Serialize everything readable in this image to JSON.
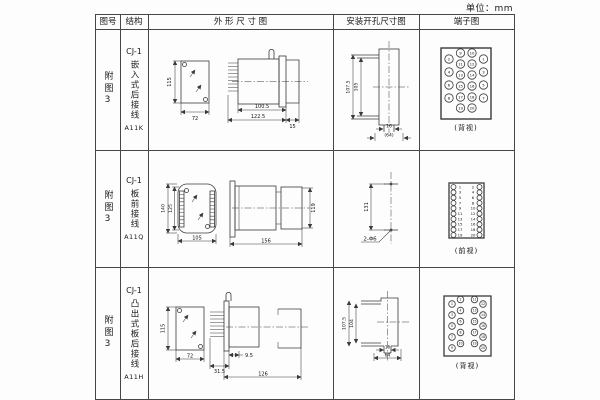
{
  "page": {
    "unit": "单位：mm"
  },
  "header": {
    "figure": "图号",
    "structure": "结构",
    "outline": "外 形 尺 寸 图",
    "mounting": "安装开孔尺寸图",
    "terminal": "端子图"
  },
  "rows": [
    {
      "figure": "附图3",
      "model": "CJ-1",
      "type": "嵌入式后接线",
      "code": "A11K",
      "outline": {
        "height": "115",
        "width": "72",
        "depth1": "100.5",
        "depth2": "122.5",
        "flange": "15"
      },
      "mount": {
        "v_outer": "107.5",
        "v_inner": "105",
        "notch": "16",
        "span": "(64)"
      },
      "terminal": {
        "caption": "(背视)",
        "numbers": [
          2,
          4,
          6,
          8,
          9,
          11,
          13,
          15,
          17,
          19,
          10,
          12,
          14,
          16,
          18,
          20,
          1,
          3,
          5,
          7
        ]
      }
    },
    {
      "figure": "附图3",
      "model": "CJ-1",
      "type": "板前接线",
      "code": "A11Q",
      "outline": {
        "height": "140",
        "inner_height": "125",
        "width": "105",
        "depth": "156",
        "side_height": "119"
      },
      "mount": {
        "spacing": "131",
        "holes": "2-Φ6"
      },
      "terminal": {
        "caption": "(前视)",
        "numbers": [
          1,
          3,
          5,
          7,
          9,
          11,
          13,
          15,
          17,
          19,
          2,
          4,
          6,
          8,
          10,
          12,
          14,
          16,
          18,
          20
        ]
      }
    },
    {
      "figure": "附图3",
      "model": "CJ-1",
      "type": "凸出式板后接线",
      "code": "A11H",
      "outline": {
        "height": "115",
        "width": "72",
        "pin_depth": "31.5",
        "offset": "9.5",
        "depth": "126"
      },
      "mount": {
        "v_outer": "107.5",
        "v_inner": "104",
        "notch": "16",
        "span": "64"
      },
      "terminal": {
        "caption": "(背视)",
        "numbers": [
          1,
          3,
          5,
          7,
          9,
          2,
          4,
          6,
          8,
          10,
          11,
          13,
          15,
          17,
          19,
          12,
          14,
          16,
          18,
          20
        ]
      }
    }
  ]
}
